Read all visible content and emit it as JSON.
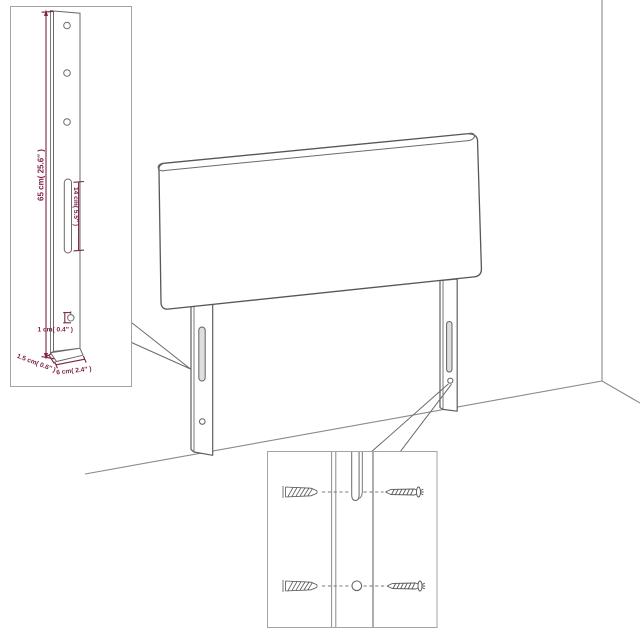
{
  "diagram": {
    "title": "headboard-with-legs-dimension-diagram",
    "colors": {
      "background": "#ffffff",
      "line_art": "#6a6a6a",
      "panel_outline": "#575757",
      "inset_border": "#a3a3a3",
      "dimension_accent": "#7e2248"
    },
    "dimension_labels": {
      "leg_height": "65 cm( 25.6″ )",
      "slot_length": "14 cm( 5.5″ )",
      "hole_size": "1 cm( 0.4″ )",
      "leg_thickness": "1.5 cm( 0.6″ )",
      "leg_width": "6 cm( 2.4″ )"
    }
  }
}
